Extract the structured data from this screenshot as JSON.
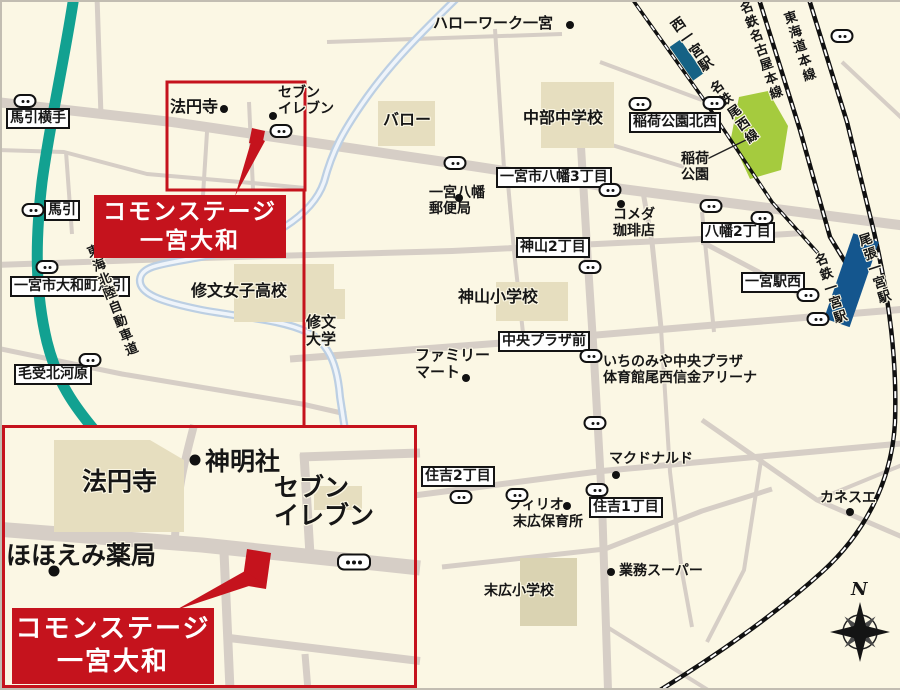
{
  "colors": {
    "background_cream": "#FBF7E4",
    "brand_red": "#C5131D",
    "expressway_teal": "#12A191",
    "station_blue": "#14568E",
    "park_green": "#A5CB3E",
    "road_gray": "#D6CEC6",
    "building_beige": "#E6DEBF",
    "river_blue": "#BCCFE3"
  },
  "map": {
    "main_callout": {
      "line1": "コモンステージ",
      "line2": "一宮大和"
    },
    "inset_callout": {
      "line1": "コモンステージ",
      "line2": "一宮大和"
    },
    "labels": [
      {
        "name": "bus-stop-umabiki-yokote-label",
        "type": "box",
        "text": "馬引横手",
        "x": 4,
        "y": 106
      },
      {
        "name": "bus-stop-umabiki-label",
        "type": "box",
        "text": "馬引",
        "x": 42,
        "y": 198
      },
      {
        "name": "bus-stop-yamatocho-umabiki-label",
        "type": "box",
        "text": "一宮市大和町馬引",
        "x": 8,
        "y": 274
      },
      {
        "name": "bus-stop-menjo-kitagawara-label",
        "type": "box",
        "text": "毛受北河原",
        "x": 12,
        "y": 362
      },
      {
        "name": "bus-stop-hachiman3-label",
        "type": "box",
        "text": "一宮市八幡3丁目",
        "x": 494,
        "y": 165
      },
      {
        "name": "bus-stop-kamiyama2-label",
        "type": "box",
        "text": "神山2丁目",
        "x": 514,
        "y": 235
      },
      {
        "name": "bus-stop-chuo-plaza-mae-label",
        "type": "box",
        "text": "中央プラザ前",
        "x": 496,
        "y": 329
      },
      {
        "name": "bus-stop-hachiman2-label",
        "type": "box",
        "text": "八幡2丁目",
        "x": 699,
        "y": 220
      },
      {
        "name": "bus-stop-ichinomiya-eki-nishi-label",
        "type": "box",
        "text": "一宮駅西",
        "x": 739,
        "y": 270
      },
      {
        "name": "bus-stop-sumiyoshi2-label",
        "type": "box",
        "text": "住吉2丁目",
        "x": 419,
        "y": 464
      },
      {
        "name": "bus-stop-sumiyoshi1-label",
        "type": "box",
        "text": "住吉1丁目",
        "x": 587,
        "y": 495
      },
      {
        "name": "bus-stop-inari-koen-hokusei-label",
        "type": "box",
        "text": "稲荷公園北西",
        "x": 627,
        "y": 110
      },
      {
        "name": "hello-work-ichinomiya-label",
        "type": "poi",
        "text": "ハローワーク一宮",
        "x": 431,
        "y": 13,
        "size": 15
      },
      {
        "name": "hoenji-temple-label",
        "type": "poi",
        "text": "法円寺",
        "x": 168,
        "y": 96,
        "size": 16
      },
      {
        "name": "seven-eleven-label",
        "type": "poi",
        "text": "セブン\nイレブン",
        "x": 276,
        "y": 84,
        "size": 14
      },
      {
        "name": "valor-label",
        "type": "poi",
        "text": "バロー",
        "x": 381,
        "y": 109,
        "size": 16
      },
      {
        "name": "chubu-junior-high-label",
        "type": "poi",
        "text": "中部中学校",
        "x": 521,
        "y": 107,
        "size": 16
      },
      {
        "name": "hachiman-post-office-label",
        "type": "poi",
        "text": "一宮八幡\n郵便局",
        "x": 427,
        "y": 184,
        "size": 14
      },
      {
        "name": "komeda-coffee-label",
        "type": "poi",
        "text": "コメダ\n珈琲店",
        "x": 611,
        "y": 206,
        "size": 14
      },
      {
        "name": "kamiyama-elementary-label",
        "type": "poi",
        "text": "神山小学校",
        "x": 456,
        "y": 286,
        "size": 16
      },
      {
        "name": "shubun-girls-high-label",
        "type": "poi",
        "text": "修文女子高校",
        "x": 189,
        "y": 280,
        "size": 16
      },
      {
        "name": "shubun-university-label",
        "type": "poi",
        "text": "修文\n大学",
        "x": 304,
        "y": 312,
        "size": 15
      },
      {
        "name": "family-mart-label",
        "type": "poi",
        "text": "ファミリー\nマート",
        "x": 413,
        "y": 345,
        "size": 15
      },
      {
        "name": "ichinomiya-chuo-plaza-arena-label",
        "type": "poi",
        "text": "いちのみや中央プラザ\n体育館尾西信金アリーナ",
        "x": 601,
        "y": 353,
        "size": 14
      },
      {
        "name": "inari-park-label",
        "type": "poi",
        "text": "稲荷\n公園",
        "x": 679,
        "y": 150,
        "size": 14
      },
      {
        "name": "mcdonalds-label",
        "type": "poi",
        "text": "マクドナルド",
        "x": 607,
        "y": 450,
        "size": 14
      },
      {
        "name": "filio-label",
        "type": "poi",
        "text": "フィリオ",
        "x": 506,
        "y": 496,
        "size": 14
      },
      {
        "name": "suehiro-nursery-label",
        "type": "poi",
        "text": "末広保育所",
        "x": 511,
        "y": 513,
        "size": 14
      },
      {
        "name": "gyomu-super-label",
        "type": "poi",
        "text": "業務スーパー",
        "x": 617,
        "y": 562,
        "size": 14
      },
      {
        "name": "suehiro-elementary-label",
        "type": "poi",
        "text": "末広小学校",
        "x": 482,
        "y": 582,
        "size": 14
      },
      {
        "name": "kanesue-label",
        "type": "poi",
        "text": "カネスエ",
        "x": 818,
        "y": 489,
        "size": 14
      },
      {
        "name": "inset-hoenji-temple-label",
        "type": "poi",
        "text": "法円寺",
        "x": 80,
        "y": 466,
        "size": 25
      },
      {
        "name": "inset-shinmeisha-shrine-label",
        "type": "poi",
        "text": "神明社",
        "x": 203,
        "y": 446,
        "size": 25
      },
      {
        "name": "inset-seven-eleven-label",
        "type": "poi",
        "text": "セブン\nイレブン",
        "x": 272,
        "y": 472,
        "size": 25
      },
      {
        "name": "inset-hohoemi-pharmacy-label",
        "type": "poi",
        "text": "ほほえみ薬局",
        "x": 4,
        "y": 540,
        "size": 25
      },
      {
        "name": "nishi-ichinomiya-station-label",
        "type": "rail",
        "text": "西一宮駅",
        "x": 664,
        "y": 22,
        "angle": -35,
        "size": 14
      },
      {
        "name": "meitetsu-bisai-line-label",
        "type": "rail",
        "text": "名鉄尾西線",
        "x": 703,
        "y": 85,
        "angle": -35,
        "size": 13
      },
      {
        "name": "meitetsu-nagoya-main-line-label",
        "type": "rail",
        "text": "名鉄名古屋本線",
        "x": 733,
        "y": 2,
        "angle": -19,
        "size": 13
      },
      {
        "name": "tokaido-main-line-label",
        "type": "rail",
        "text": "東海道本線",
        "x": 777,
        "y": 12,
        "angle": -18,
        "size": 13
      },
      {
        "name": "meitetsu-ichinomiya-station-label",
        "type": "rail",
        "text": "名鉄一宮駅",
        "x": 808,
        "y": 254,
        "angle": -18,
        "size": 13
      },
      {
        "name": "owari-ichinomiya-station-label",
        "type": "rail",
        "text": "尾張一宮駅",
        "x": 852,
        "y": 234,
        "angle": -18,
        "size": 13
      },
      {
        "name": "tokai-hokuriku-expressway-label",
        "type": "rail",
        "text": "東海北陸自動車道",
        "x": 80,
        "y": 246,
        "angle": -21,
        "size": 13
      },
      {
        "name": "compass-north-letter",
        "type": "north",
        "text": "N",
        "x": 849,
        "y": 578
      }
    ],
    "poi_dots": [
      {
        "name": "dot-hello-work",
        "x": 568,
        "y": 23
      },
      {
        "name": "dot-hoenji",
        "x": 222,
        "y": 107
      },
      {
        "name": "dot-seven-eleven",
        "x": 271,
        "y": 114
      },
      {
        "name": "dot-hachiman-post-office",
        "x": 457,
        "y": 196
      },
      {
        "name": "dot-komeda",
        "x": 619,
        "y": 202
      },
      {
        "name": "dot-family-mart",
        "x": 464,
        "y": 376
      },
      {
        "name": "dot-mcdonalds",
        "x": 614,
        "y": 473
      },
      {
        "name": "dot-filio",
        "x": 565,
        "y": 504
      },
      {
        "name": "dot-gyomu-super",
        "x": 609,
        "y": 570
      },
      {
        "name": "dot-kanesue",
        "x": 848,
        "y": 510
      },
      {
        "name": "dot-inset-shinmeisha",
        "x": 193,
        "y": 458,
        "r": 6
      },
      {
        "name": "dot-inset-hohoemi",
        "x": 52,
        "y": 569,
        "r": 7
      }
    ],
    "bus_stops": [
      {
        "x": 23,
        "y": 99
      },
      {
        "x": 31,
        "y": 208
      },
      {
        "x": 45,
        "y": 265
      },
      {
        "x": 88,
        "y": 358
      },
      {
        "x": 279,
        "y": 129
      },
      {
        "x": 453,
        "y": 161
      },
      {
        "x": 608,
        "y": 188
      },
      {
        "x": 638,
        "y": 102
      },
      {
        "x": 712,
        "y": 101
      },
      {
        "x": 840,
        "y": 34
      },
      {
        "x": 709,
        "y": 204
      },
      {
        "x": 760,
        "y": 216
      },
      {
        "x": 588,
        "y": 265
      },
      {
        "x": 589,
        "y": 354
      },
      {
        "x": 593,
        "y": 421
      },
      {
        "x": 459,
        "y": 495
      },
      {
        "x": 515,
        "y": 493
      },
      {
        "x": 595,
        "y": 488
      },
      {
        "x": 806,
        "y": 293
      },
      {
        "x": 816,
        "y": 317
      },
      {
        "x": 352,
        "y": 560,
        "big": true
      }
    ]
  }
}
